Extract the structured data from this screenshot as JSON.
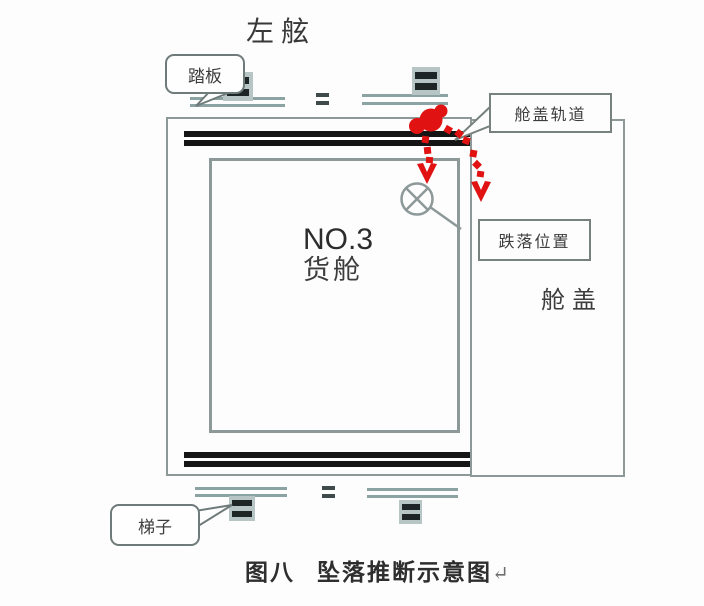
{
  "figure": {
    "port_side_title": "左舷",
    "labels": {
      "pedal": "踏板",
      "hatch_rail": "舱盖轨道",
      "fall_position": "跌落位置",
      "cargo_hold_line1": "NO.3",
      "cargo_hold_line2": "货舱",
      "hatch_cover": "舱盖",
      "ladder": "梯子"
    },
    "caption": {
      "figure_label": "图八",
      "figure_title": "坠落推断示意图",
      "return_mark": "↵"
    },
    "icons": {
      "fall_start_marker": "red-blob-person",
      "fall_path_arrows": "red-dotted-arrows",
      "impact_marker": "circle-with-x",
      "ladder_symbols": "dark-double-rungs",
      "equals_marks": "double-dash"
    },
    "colors": {
      "outline_gray": "#8d9898",
      "deck_line_teal": "#8ba3a3",
      "coaming_black": "#151515",
      "accent_red": "#e01212",
      "callout_border": "#6f7b7a",
      "text_dark": "#3d3d3d"
    }
  }
}
